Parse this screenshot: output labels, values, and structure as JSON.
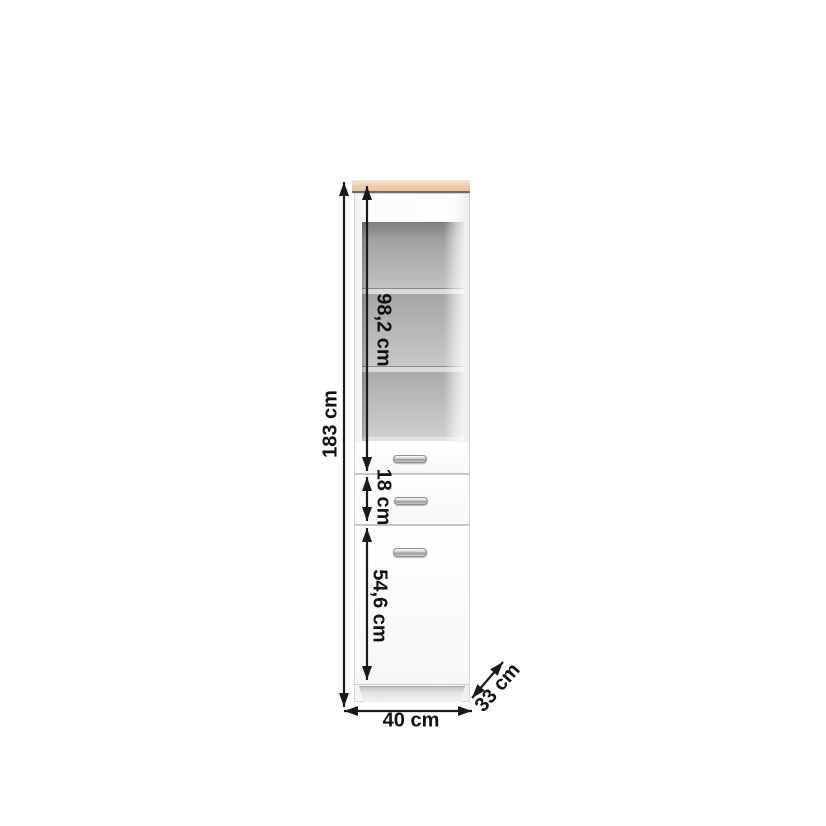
{
  "diagram": {
    "kind": "furniture-dimension-drawing",
    "item": "tall cabinet with open shelf niche, two drawers and one door",
    "dimensions": {
      "total_height": "183 cm",
      "niche_section_height": "98,2 cm",
      "drawer_section_height": "18 cm",
      "door_section_height": "54,6 cm",
      "width": "40 cm",
      "depth": "33 cm"
    },
    "colors": {
      "background": "#ffffff",
      "top_panel_wood": "#eed2b4",
      "top_panel_edge": "#6f6a61",
      "cabinet_body": "#fafafa",
      "panel_divider_lines": "#c6c6c6",
      "niche_interior_dark": "#7e7e7e",
      "niche_interior_light": "#cfcfcf",
      "handle_metal": "#b9b9b9",
      "dimension_ink": "#1a1a1a"
    }
  }
}
